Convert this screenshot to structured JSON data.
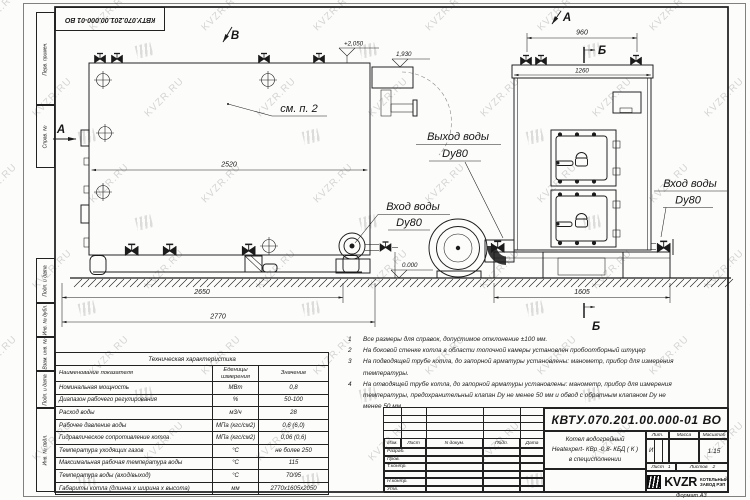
{
  "watermark": {
    "text": "KVZR.RU"
  },
  "doc_number": "КВТУ.070.201.00.000-01 ВО",
  "margin_boxes": [
    "Перв. примен.",
    "Справ. №",
    "Подп. и дата",
    "Инв. № дубл.",
    "Взам. инв. №",
    "Подп. и дата",
    "Инв. № подл."
  ],
  "drawing": {
    "view_markers": {
      "a": "А",
      "b": "Б",
      "v": "В"
    },
    "see_note": "см. п. 2",
    "water_inlet": "Вход воды",
    "water_outlet": "Выход воды",
    "dn": "Dy80",
    "dims": {
      "side_width": "2520",
      "side_base": "2650",
      "side_overall": "2770",
      "front_valves": "960",
      "front_top": "1260",
      "front_base": "1605"
    },
    "elevations": {
      "top": "+2,050",
      "ledge": "1,930",
      "zero": "0.000"
    }
  },
  "notes": [
    {
      "num": "1",
      "text": "Все размеры для справок, допустимое отклонение ±100 мм."
    },
    {
      "num": "2",
      "text": "На боковой стенке котла в области топочной камеры установлен пробоотборный штуцер"
    },
    {
      "num": "3",
      "text": "На подводящей трубе котла, до запорной арматуры установлены: манометр, прибор для измерения температуры."
    },
    {
      "num": "4",
      "text": "На отводящей трубе котла, до запорной арматуры установлены: манометр, прибор для измерения температуры, предохранительный клапан Dу не менее 50 мм и обвод с обратным клапаном Dу не менее 50 мм."
    }
  ],
  "tech_table": {
    "caption": "Техническая характеристика",
    "headers": [
      "Наименование показателя",
      "Еденицы измерения",
      "Значение"
    ],
    "rows": [
      [
        "Номинальная мощность",
        "МВт",
        "0,8"
      ],
      [
        "Диапазон рабочего регулирования",
        "%",
        "50-100"
      ],
      [
        "Расход воды",
        "м3/ч",
        "28"
      ],
      [
        "Рабочее давление воды",
        "МПа (кгс/см2)",
        "0,6 (6,0)"
      ],
      [
        "Гидравлическое сопротивление котла",
        "МПа (кгс/см2)",
        "0,06 (0,6)"
      ],
      [
        "Температура уходящих газов",
        "°С",
        "не более 250"
      ],
      [
        "Максимальная рабочая температура воды",
        "°С",
        "115"
      ],
      [
        "Температура воды (вход/выход)",
        "°С",
        "70/95"
      ],
      [
        "Габариты котла (длинна х ширина х высота)",
        "мм",
        "2770х1605х2050"
      ]
    ]
  },
  "title_block": {
    "change_cols": [
      "Изм.",
      "Лист",
      "N докум.",
      "Подп.",
      "Дата"
    ],
    "sig_labels": [
      "Разраб.",
      "Пров.",
      "Т.контр.",
      "",
      "Н.контр.",
      "Утв."
    ],
    "product": [
      "Котел водогрейный",
      "Heatexpert- КВр -0,8- КБД ( К )",
      "в специсполнении"
    ],
    "lit_label": "Лит.",
    "mass_label": "Масса",
    "scale_label": "Масштаб",
    "lit": "И",
    "scale": "1:15",
    "sheet_label": "Лист",
    "sheet_num": "1",
    "sheets_label": "Листов",
    "sheets_num": "2",
    "logo": "KVZR",
    "logo_sub1": "КОТЕЛЬНЫЙ",
    "logo_sub2": "ЗАВОД РЭП",
    "format": "Формат  А3"
  }
}
